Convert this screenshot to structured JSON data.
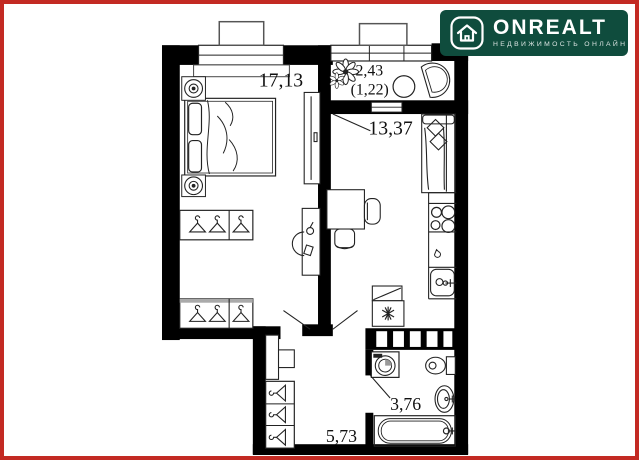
{
  "frame": {
    "border_color": "#c32a23",
    "background": "#ffffff"
  },
  "watermark": {
    "brand": "ONREALT",
    "tagline": "НЕДВИЖИМОСТЬ ОНЛАЙН",
    "bg_color": "#0f4c3d",
    "text_color": "#ffffff",
    "icon": "house-icon"
  },
  "plan": {
    "wall_color": "#000000",
    "rooms": [
      {
        "name": "bedroom",
        "area": "17,13"
      },
      {
        "name": "loggia",
        "area": "2,43",
        "area_reduced": "(1,22)"
      },
      {
        "name": "kitchen-living-room",
        "area": "13,37"
      },
      {
        "name": "bathroom",
        "area": "3,76"
      },
      {
        "name": "hallway",
        "area": "5,73"
      }
    ],
    "furniture_icons": [
      "double-bed-icon",
      "pillow-icon",
      "plant-pot-icon",
      "wardrobe-hanger-icon",
      "tv-cabinet-icon",
      "desk-icon",
      "chair-icon",
      "sofa-icon",
      "cushion-icon",
      "stove-burners-icon",
      "kitchen-sink-icon",
      "fridge-snowflake-icon",
      "flower-icon",
      "round-table-icon",
      "fan-armchair-icon",
      "dresser-icon",
      "washing-machine-icon",
      "toilet-icon",
      "washbasin-icon",
      "bathtub-icon",
      "door-swing-icon",
      "window-icon",
      "vent-shaft-icon"
    ]
  }
}
